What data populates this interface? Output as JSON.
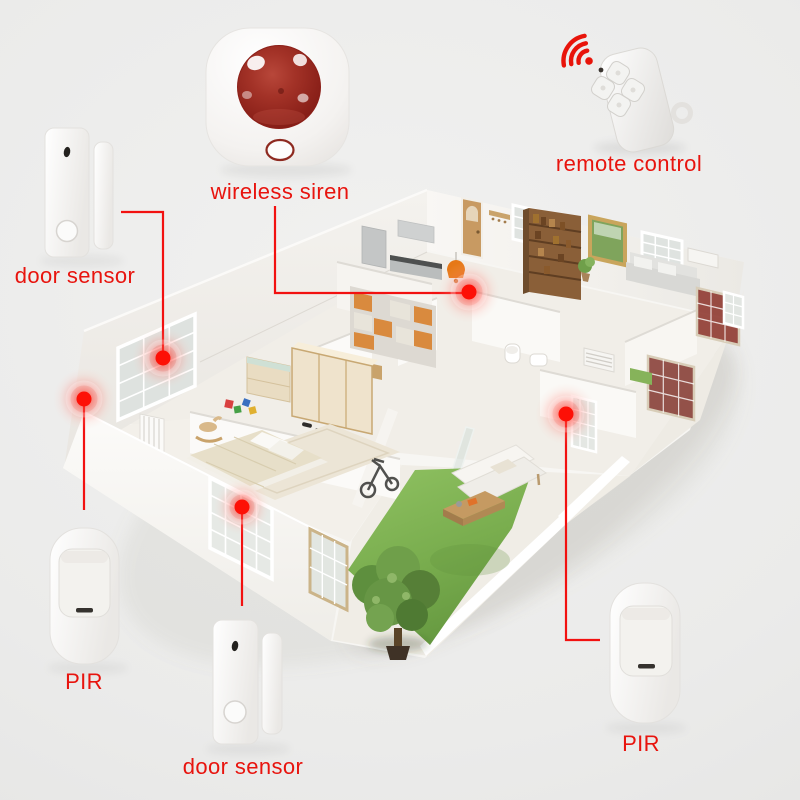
{
  "colors": {
    "background": "#ebebea",
    "label_red": "#e8140e",
    "connector_red": "#f21110",
    "marker_red": "#fd1006",
    "siren_dome_red": "#9c2b24",
    "grass_green": "#79ad4e",
    "wood_tan": "#c89a62",
    "orange_accent": "#e67817"
  },
  "devices": [
    {
      "id": "door-sensor-top",
      "type": "magnetic-door-sensor",
      "label": "door sensor"
    },
    {
      "id": "wireless-siren",
      "type": "strobe-siren",
      "label": "wireless siren"
    },
    {
      "id": "remote-control",
      "type": "keyfob-remote",
      "label": "remote control"
    },
    {
      "id": "pir-bottom-left",
      "type": "pir-motion-sensor",
      "label": "PIR"
    },
    {
      "id": "door-sensor-bottom",
      "type": "magnetic-door-sensor",
      "label": "door sensor"
    },
    {
      "id": "pir-bottom-right",
      "type": "pir-motion-sensor",
      "label": "PIR"
    }
  ],
  "floorplan": {
    "style": "isometric-3d-apartment-cutaway",
    "sensor_markers": [
      {
        "id": "marker-left-wall-window"
      },
      {
        "id": "marker-left-wall-corner"
      },
      {
        "id": "marker-front-bedroom-window"
      },
      {
        "id": "marker-entry-hallway"
      },
      {
        "id": "marker-rear-hallway-door"
      }
    ]
  }
}
